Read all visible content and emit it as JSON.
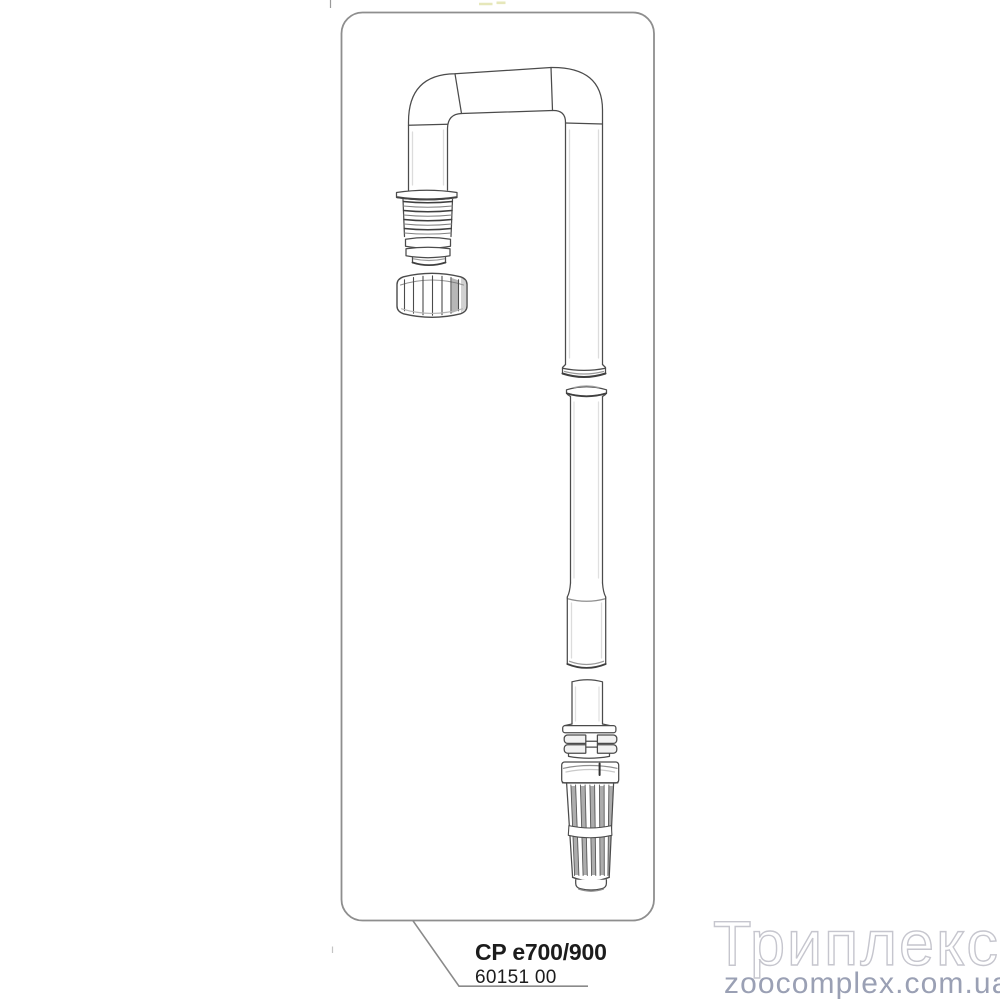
{
  "page": {
    "background_color": "#ffffff"
  },
  "frame": {
    "border_color": "#8e8e8e"
  },
  "diagram": {
    "line_color": "#4b4b4b",
    "parts": [
      "outflow-elbow-tube",
      "threaded-hose-connector",
      "union-nut",
      "intake-tube-middle-section",
      "coupling-sleeve",
      "extension-tube",
      "quick-release-clip-connector",
      "intake-strainer"
    ]
  },
  "label": {
    "product_name": "CP e700/900",
    "product_code": "60151 00",
    "text_color": "#1c1c1c"
  },
  "watermark": {
    "brand": "Триплекс",
    "site": "zoocomplex.com.ua",
    "brand_outline_color": "#c6c6ce",
    "site_color": "#9aa0b4"
  },
  "artifacts": {
    "top_dash_color": "#e6e7ba"
  }
}
